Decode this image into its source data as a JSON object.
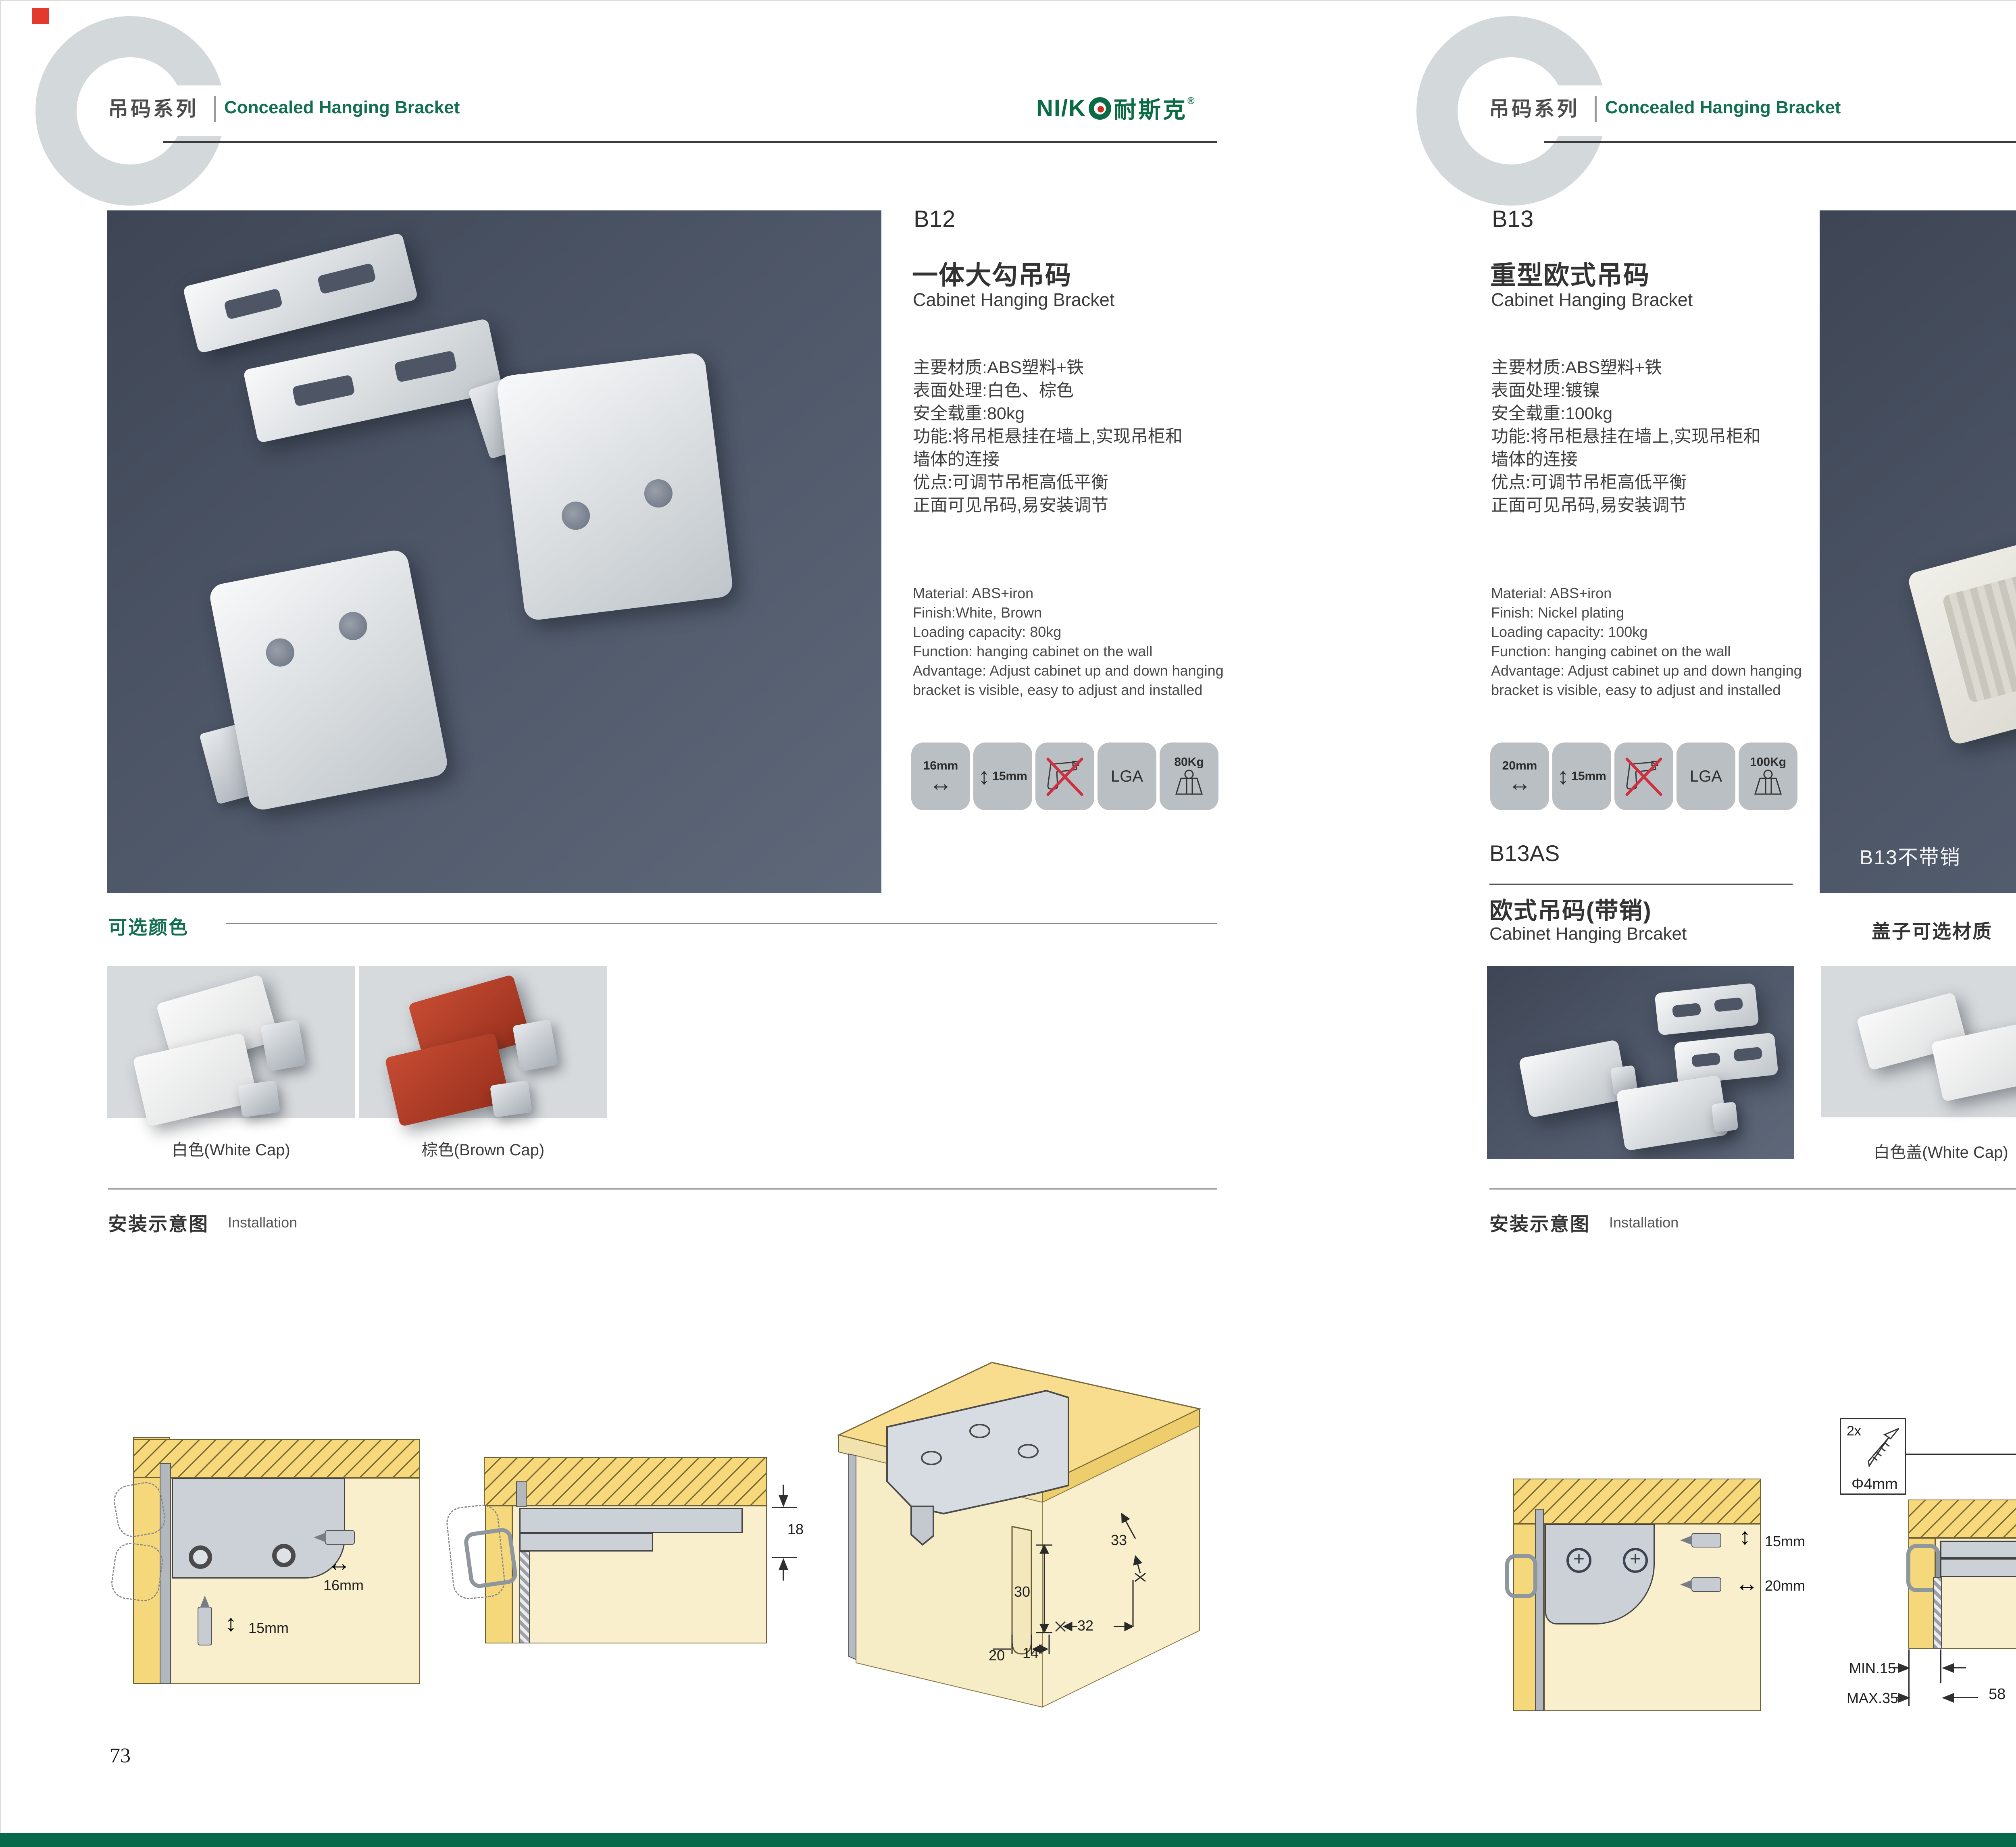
{
  "brand": {
    "logo_latin": "NI/K",
    "logo_cjk": "耐斯克",
    "logo_reg": "®"
  },
  "left": {
    "header": {
      "series": "吊码系列",
      "subtitle": "Concealed Hanging Bracket"
    },
    "product": {
      "code": "B12",
      "name_cn": "一体大勾吊码",
      "name_en": "Cabinet Hanging Bracket",
      "specs_cn": [
        "主要材质:ABS塑料+铁",
        "表面处理:白色、棕色",
        "安全载重:80kg",
        "功能:将吊柜悬挂在墙上,实现吊柜和",
        "墙体的连接",
        "优点:可调节吊柜高低平衡",
        "正面可见吊码,易安装调节"
      ],
      "specs_en": [
        "Material: ABS+iron",
        "Finish:White, Brown",
        "Loading capacity: 80kg",
        "Function: hanging cabinet on the wall",
        "Advantage: Adjust cabinet up and down hanging",
        "bracket is visible, easy to adjust and installed"
      ],
      "icons": {
        "i1": "16mm",
        "i2": "15mm",
        "i4": "LGA",
        "i5": "80Kg"
      }
    },
    "colors": {
      "title": "可选颜色",
      "swatch1": "白色(White Cap)",
      "swatch2": "棕色(Brown Cap)"
    },
    "installation": {
      "title_cn": "安装示意图",
      "title_en": "Installation",
      "d1": {
        "w": "16mm",
        "h": "15mm"
      },
      "d2": {
        "t": "18"
      },
      "d3": {
        "a33": "33",
        "a30": "30",
        "a32": "32",
        "a20": "20",
        "a14": "14"
      }
    },
    "page_number": "73"
  },
  "right": {
    "header": {
      "series": "吊码系列",
      "subtitle": "Concealed Hanging Bracket"
    },
    "product": {
      "code": "B13",
      "name_cn": "重型欧式吊码",
      "name_en": "Cabinet Hanging Bracket",
      "specs_cn": [
        "主要材质:ABS塑料+铁",
        "表面处理:镀镍",
        "安全载重:100kg",
        "功能:将吊柜悬挂在墙上,实现吊柜和",
        "墙体的连接",
        "优点:可调节吊柜高低平衡",
        "正面可见吊码,易安装调节"
      ],
      "specs_en": [
        "Material: ABS+iron",
        "Finish: Nickel plating",
        "Loading capacity: 100kg",
        "Function: hanging cabinet on the wall",
        "Advantage: Adjust cabinet up and down hanging",
        "bracket is visible, easy to adjust and installed"
      ],
      "icons": {
        "i1": "20mm",
        "i2": "15mm",
        "i4": "LGA",
        "i5": "100Kg"
      },
      "photo_label": "B13不带销"
    },
    "sub_product": {
      "code": "B13AS",
      "name_cn": "欧式吊码(带销)",
      "name_en": "Cabinet Hanging Brcaket"
    },
    "caps": {
      "title": "盖子可选材质",
      "swatch1": "白色盖(White Cap)",
      "swatch2": "灰色盖(Gray Cap)"
    },
    "installation": {
      "title_cn": "安装示意图",
      "title_en": "Installation",
      "d1": {
        "v": "15mm",
        "h": "20mm"
      },
      "d2": {
        "count": "2x",
        "dia": "Φ4mm",
        "side": "18",
        "min": "MIN.15",
        "max": "MAX.35",
        "mid": "58"
      },
      "d3": {
        "a16": "16",
        "a40": "40",
        "armax": "RMAX4",
        "a19": "19",
        "a32": "32",
        "a18": "18"
      }
    },
    "page_number": "74"
  }
}
